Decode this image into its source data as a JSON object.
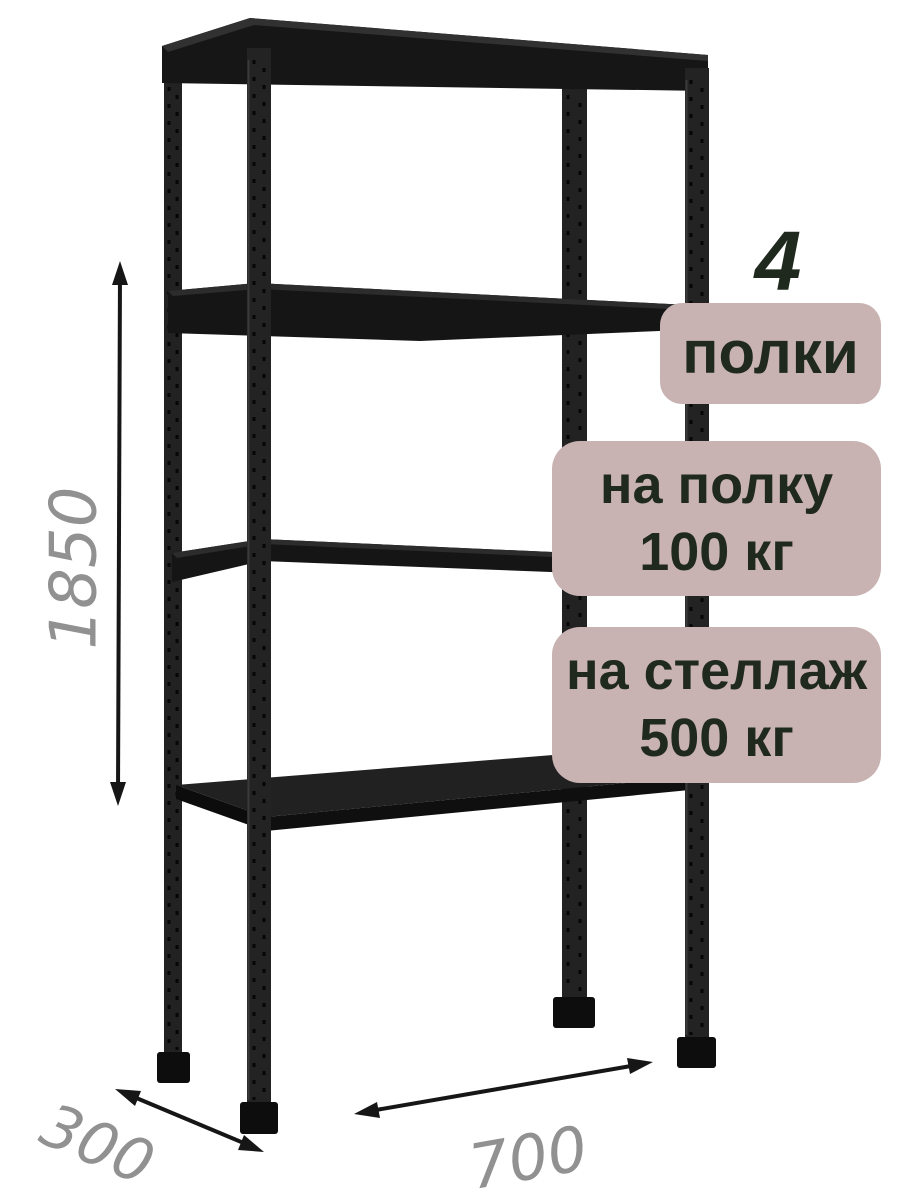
{
  "badges": {
    "shelf_count": "4",
    "shelf_count_label": "полки",
    "per_shelf_line1": "на полку",
    "per_shelf_line2": "100 кг",
    "per_rack_line1": "на стеллаж",
    "per_rack_line2": "500 кг"
  },
  "dimensions": {
    "height_mm": "1850",
    "depth_mm": "300",
    "width_mm": "700"
  },
  "icons": {
    "height_arrow": "double-headed-vertical-arrow",
    "depth_arrow": "double-headed-diagonal-arrow",
    "width_arrow": "double-headed-horizontal-arrow"
  },
  "colors": {
    "background": "#ffffff",
    "badge_background": "#c8b2b2",
    "badge_text": "#1f291d",
    "metal_dark": "#1a1a1a",
    "metal_post": "#222222",
    "dimension_label": "#919191",
    "dimension_arrow": "#161616"
  }
}
